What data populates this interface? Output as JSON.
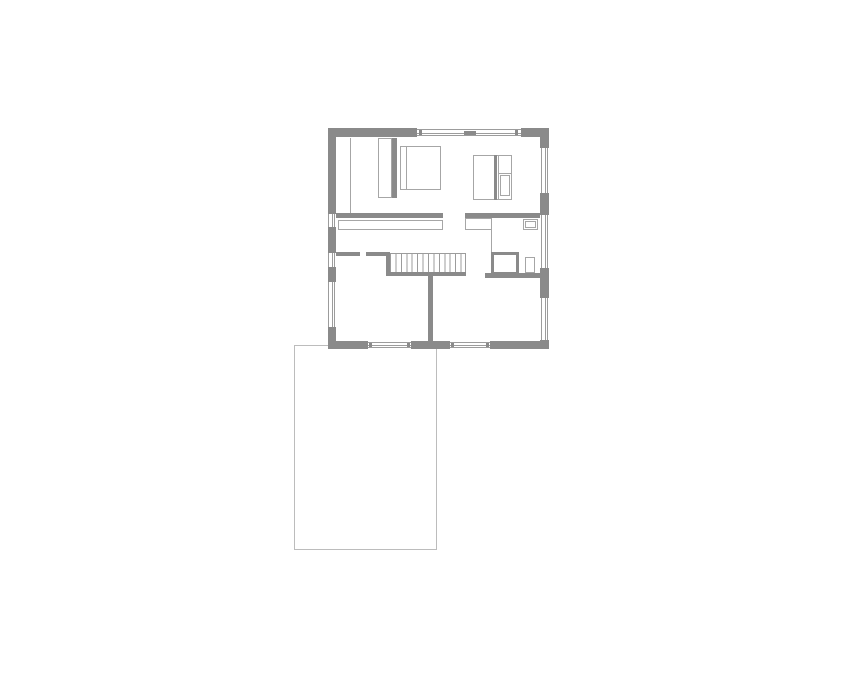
{
  "meta": {
    "drawing_type": "floor-plan",
    "visible_text": [],
    "window_marker_present": true
  },
  "colors": {
    "background": "#ffffff",
    "wall": "#8a8a8a",
    "frame_line": "#9c9c9c",
    "furniture_line": "#a6a6a6",
    "terrace_line": "#bcbcbc"
  },
  "stairs": {
    "tread_count": 14
  },
  "elements": [
    "exterior-walls",
    "windows",
    "interior-walls",
    "staircase",
    "bed",
    "wardrobe",
    "built-in-unit",
    "closet-strip",
    "vanity-strip",
    "shower",
    "toilet",
    "sink",
    "terrace-outline"
  ]
}
